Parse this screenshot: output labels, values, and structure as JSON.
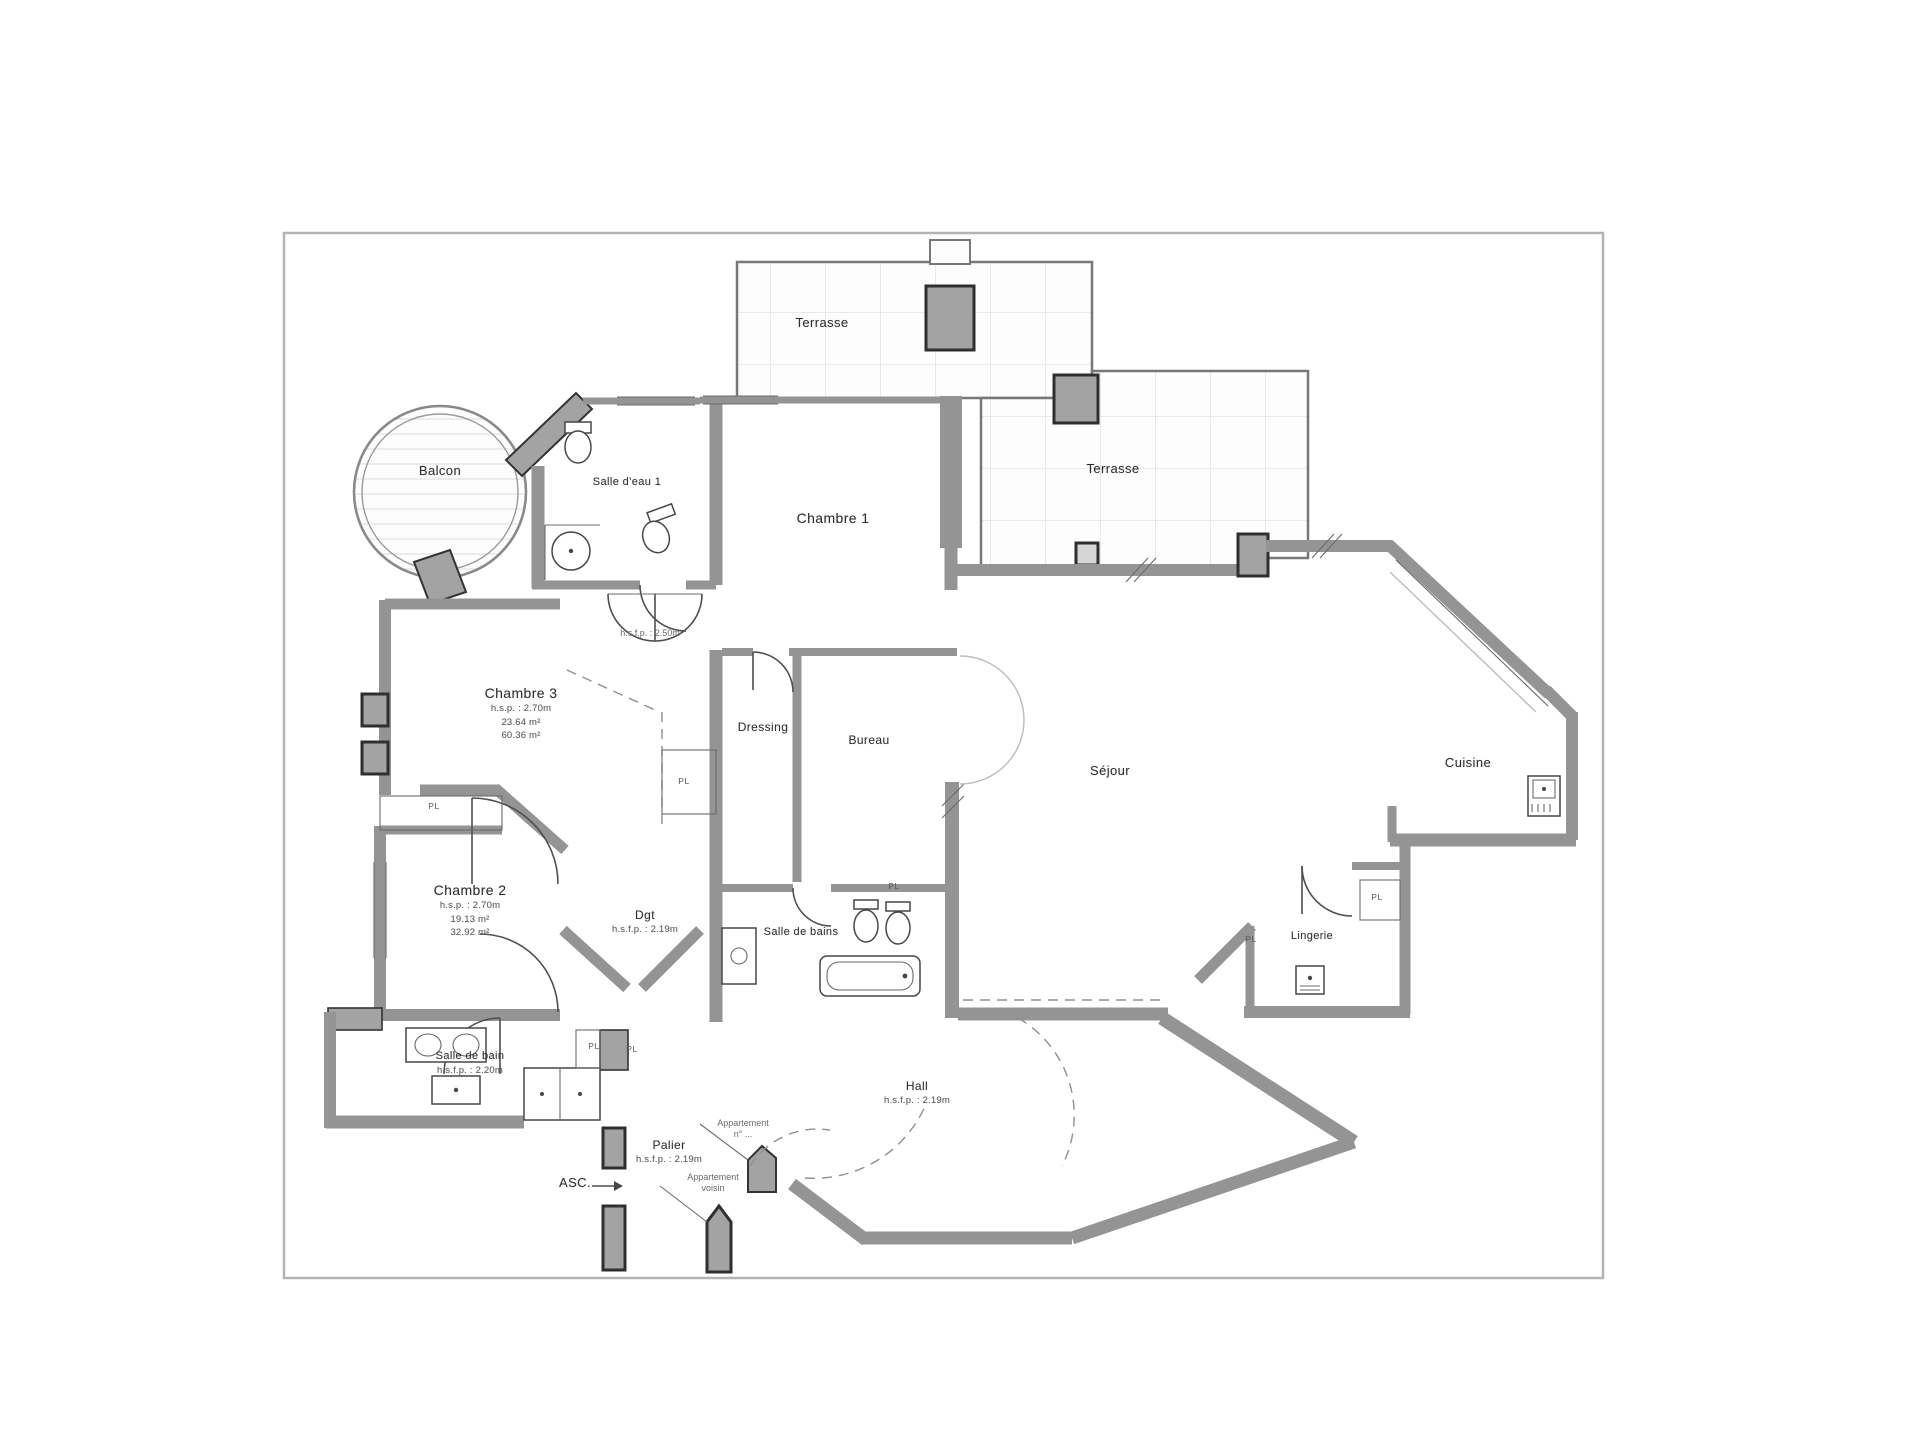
{
  "drawing": {
    "type": "floor-plan",
    "language": "fr",
    "colors": {
      "background": "#ffffff",
      "wall_gray": "#949494",
      "pillar_fill": "#a3a3a3",
      "pillar_stroke": "#2f2f2f",
      "line_dark": "#4f4f4f",
      "grid_light": "#dedede",
      "label_text": "#2e2e2e",
      "sub_text": "#5a5a5a",
      "frame": "#b3b3b3"
    }
  },
  "rooms": [
    {
      "id": "terrasse-top",
      "label": "Terrasse",
      "x": 822,
      "y": 322,
      "size": 13,
      "sub": []
    },
    {
      "id": "terrasse-right",
      "label": "Terrasse",
      "x": 1113,
      "y": 468,
      "size": 13,
      "sub": []
    },
    {
      "id": "balcon",
      "label": "Balcon",
      "x": 440,
      "y": 470,
      "size": 13,
      "sub": []
    },
    {
      "id": "salle-deau-1",
      "label": "Salle d'eau 1",
      "x": 627,
      "y": 482,
      "size": 11,
      "sub": []
    },
    {
      "id": "chambre-1",
      "label": "Chambre 1",
      "x": 833,
      "y": 518,
      "size": 14,
      "sub": []
    },
    {
      "id": "chambre-3",
      "label": "Chambre 3",
      "x": 521,
      "y": 693,
      "size": 14,
      "sub": [
        "h.s.p. : 2.70m",
        "23.64 m²",
        "60.36 m²"
      ]
    },
    {
      "id": "dressing",
      "label": "Dressing",
      "x": 763,
      "y": 727,
      "size": 12,
      "sub": []
    },
    {
      "id": "bureau",
      "label": "Bureau",
      "x": 869,
      "y": 740,
      "size": 12,
      "sub": []
    },
    {
      "id": "sejour",
      "label": "Séjour",
      "x": 1110,
      "y": 770,
      "size": 13,
      "sub": []
    },
    {
      "id": "cuisine",
      "label": "Cuisine",
      "x": 1468,
      "y": 762,
      "size": 13,
      "sub": []
    },
    {
      "id": "chambre-2",
      "label": "Chambre 2",
      "x": 470,
      "y": 890,
      "size": 14,
      "sub": [
        "h.s.p. : 2.70m",
        "19.13 m²",
        "32.92 m²"
      ]
    },
    {
      "id": "dgt",
      "label": "Dgt",
      "x": 645,
      "y": 915,
      "size": 12,
      "sub": [
        "h.s.f.p. : 2.19m"
      ]
    },
    {
      "id": "salle-de-bains",
      "label": "Salle de bains",
      "x": 801,
      "y": 932,
      "size": 11,
      "sub": []
    },
    {
      "id": "lingerie",
      "label": "Lingerie",
      "x": 1312,
      "y": 936,
      "size": 11,
      "sub": []
    },
    {
      "id": "salle-de-bain",
      "label": "Salle de bain",
      "x": 470,
      "y": 1056,
      "size": 11,
      "sub": [
        "h.s.f.p. : 2.20m"
      ]
    },
    {
      "id": "hall",
      "label": "Hall",
      "x": 917,
      "y": 1086,
      "size": 12,
      "sub": [
        "h.s.f.p. : 2.19m"
      ]
    },
    {
      "id": "palier",
      "label": "Palier",
      "x": 669,
      "y": 1145,
      "size": 12,
      "sub": [
        "h.s.f.p. : 2.19m"
      ]
    },
    {
      "id": "asc",
      "label": "ASC.",
      "x": 575,
      "y": 1182,
      "size": 13,
      "sub": []
    }
  ],
  "closets": [
    {
      "label": "PL",
      "x": 434,
      "y": 806
    },
    {
      "label": "PL",
      "x": 684,
      "y": 781
    },
    {
      "label": "PL",
      "x": 894,
      "y": 886
    },
    {
      "label": "PL",
      "x": 1377,
      "y": 897
    },
    {
      "label": "PL",
      "x": 1251,
      "y": 939
    },
    {
      "label": "PL",
      "x": 594,
      "y": 1046
    },
    {
      "label": "PL",
      "x": 632,
      "y": 1049
    }
  ],
  "annotations": [
    {
      "id": "height-note-dgt-upper",
      "lines": [
        "h.s.f.p. : 2.50m"
      ],
      "x": 650,
      "y": 628
    },
    {
      "id": "entry-note-1",
      "lines": [
        "Appartement",
        "n° ..."
      ],
      "x": 743,
      "y": 1118
    },
    {
      "id": "entry-note-2",
      "lines": [
        "Appartement",
        "voisin"
      ],
      "x": 713,
      "y": 1172
    }
  ]
}
